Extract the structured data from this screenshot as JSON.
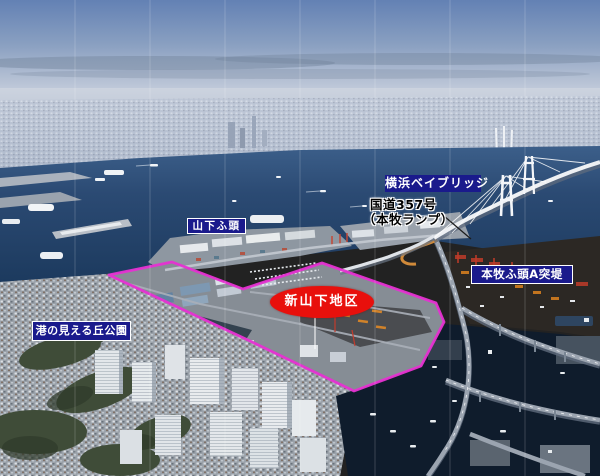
{
  "annotations": {
    "bay_bridge": {
      "label": "横浜ベイブリッジ"
    },
    "route357": {
      "line1": "国道357号",
      "line2": "（本牧ランプ）"
    },
    "yamashita_pier": {
      "label": "山下ふ頭"
    },
    "honmoku_pier_a": {
      "label": "本牧ふ頭A突堤"
    },
    "shin_yamashita_district": {
      "label": "新山下地区"
    },
    "harbor_view_park": {
      "label": "港の見える丘公園"
    }
  },
  "colors": {
    "label_background": "#1a1a8c",
    "label_border": "#ffffff",
    "label_text": "#ffffff",
    "district_outline_magenta": "#e632d2",
    "district_ellipse_red": "#e8100c",
    "route_label_text": "#000000",
    "route_label_halo": "#ffffff"
  }
}
